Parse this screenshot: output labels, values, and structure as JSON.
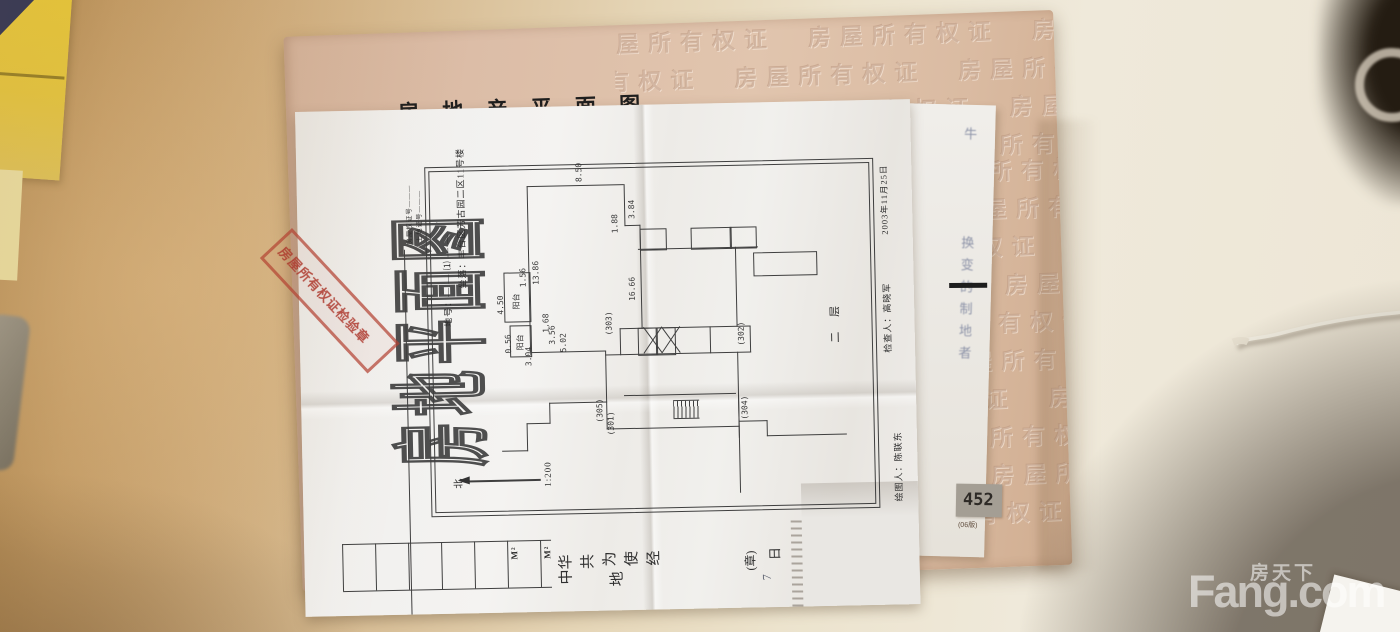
{
  "watermark": {
    "cn": "房天下",
    "en": "Fang.com"
  },
  "booklet": {
    "form_title": "房 地 产 平 面 图",
    "sheet_no_label": "图幅号:",
    "notes_header": "注意事项",
    "emboss_row": "房屋所有权证　房屋所有权证　房屋所有权证　房屋所有权证",
    "serial_number": "452",
    "serial_edition": "(06版)"
  },
  "sheet": {
    "vertical_title": "房地平面图",
    "stamp_text": "房屋所有权证检验章",
    "cert_no_line": "房屋权证号———",
    "land_no_line": "土地证号———",
    "lot_no_line": "地号：— — ⑴ — —",
    "location_line": "坐落：丰台区芳古园二区11号楼",
    "floor_label": "二 层",
    "north_label": "北",
    "scale_label": "1:200",
    "date_line": "2003年11月25日",
    "checker_line": "检查人：高晓军",
    "drafter_line": "绘图人：陈联东",
    "balcony_label": "阳台",
    "unit_label": "M²",
    "rooms": [
      "(301)",
      "(302)",
      "(303)",
      "(304)",
      "(305)"
    ],
    "dims": [
      "8.50",
      "13.86",
      "3.84",
      "1.88",
      "16.66",
      "4.50",
      "1.56",
      "1.68",
      "0.56",
      "3.04",
      "5.02",
      "3.56"
    ],
    "boilerplate": [
      "中华",
      "共",
      "为",
      "使",
      "经",
      "地"
    ],
    "seal_note": "(章)",
    "day_label": "日",
    "handwritten_digit": "7"
  },
  "side_sheet": {
    "handwriting_top": "牛",
    "handwriting_body": "换变的制地者"
  },
  "colors": {
    "stamp_red": "#a94a3d",
    "booklet_orange": "#dcbda9",
    "desk_warm": "#c9a474",
    "plan_line": "#3f3f3f",
    "watermark_white": "rgba(255,255,255,0.55)"
  }
}
